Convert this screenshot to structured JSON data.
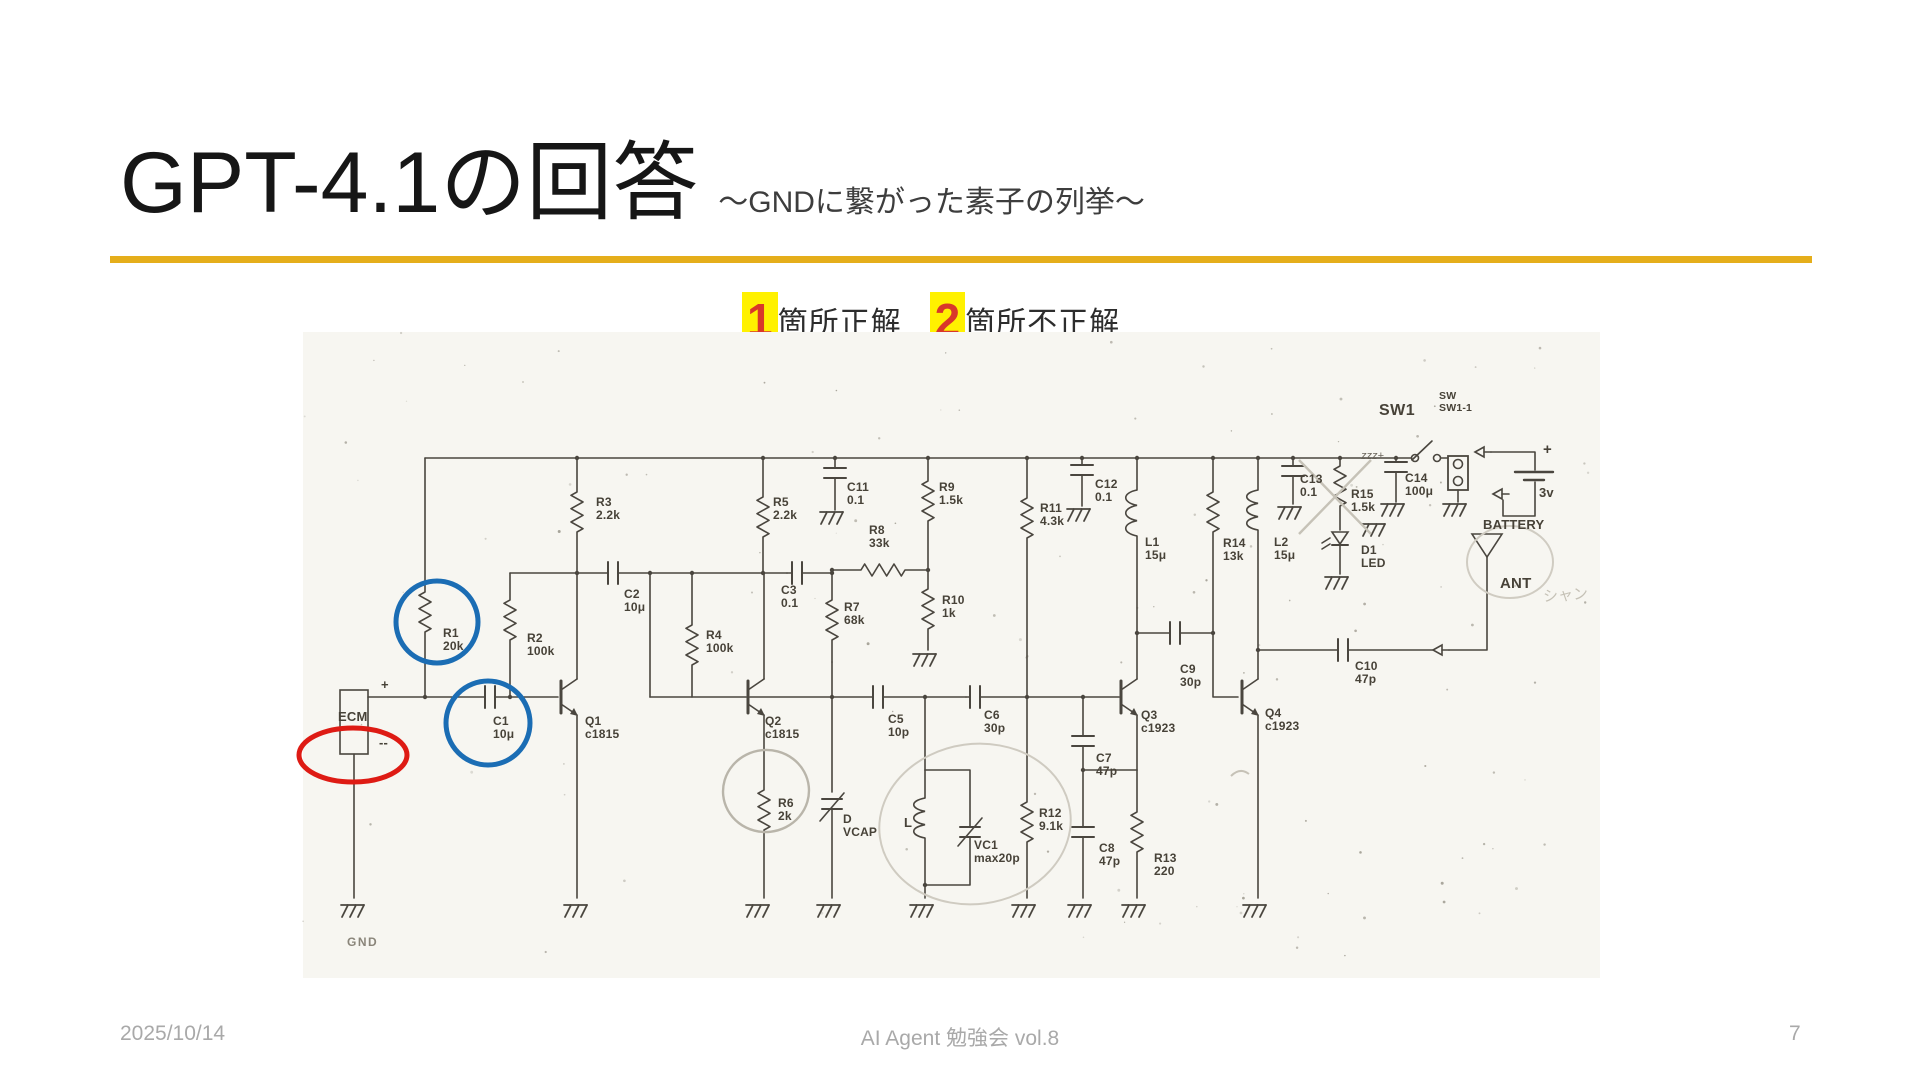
{
  "slide": {
    "title": "GPT-4.1の回答",
    "subtitle": "～GNDに繋がった素子の列挙～",
    "result": {
      "correct_count": "1",
      "correct_label": "箇所正解",
      "incorrect_count": "2",
      "incorrect_label": "箇所不正解"
    },
    "footer": {
      "date": "2025/10/14",
      "event": "AI Agent 勉強会 vol.8",
      "page": "7"
    }
  },
  "colors": {
    "rule_gold": "#E5AE1B",
    "highlight_yellow": "#FFF100",
    "count_red": "#D9372A",
    "annotation_blue": "#1B6DB4",
    "annotation_red": "#DE1B14",
    "ink": "#4a463f",
    "pencil": "#c6c2b7",
    "paper": "#f7f6f1"
  },
  "circuit": {
    "labels": [
      {
        "t": "R1\n20k",
        "x": 140,
        "y": 295
      },
      {
        "t": "R2\n100k",
        "x": 224,
        "y": 300
      },
      {
        "t": "C1\n10μ",
        "x": 190,
        "y": 383
      },
      {
        "t": "Q1\nc1815",
        "x": 282,
        "y": 383
      },
      {
        "t": "ECM",
        "x": 35,
        "y": 378,
        "s": "md"
      },
      {
        "t": "+",
        "x": 78,
        "y": 346,
        "s": "md"
      },
      {
        "t": "--",
        "x": 76,
        "y": 404,
        "s": "md"
      },
      {
        "t": "GND",
        "x": 44,
        "y": 604,
        "s": "gndlbl"
      },
      {
        "t": "R3\n2.2k",
        "x": 293,
        "y": 164
      },
      {
        "t": "C2\n10μ",
        "x": 321,
        "y": 256
      },
      {
        "t": "R4\n100k",
        "x": 403,
        "y": 297
      },
      {
        "t": "R5\n2.2k",
        "x": 470,
        "y": 164
      },
      {
        "t": "C3\n0.1",
        "x": 478,
        "y": 252
      },
      {
        "t": "C11\n0.1",
        "x": 544,
        "y": 149
      },
      {
        "t": "R9\n1.5k",
        "x": 636,
        "y": 149
      },
      {
        "t": "R8\n33k",
        "x": 566,
        "y": 192
      },
      {
        "t": "R7\n68k",
        "x": 541,
        "y": 269
      },
      {
        "t": "R10\n1k",
        "x": 639,
        "y": 262
      },
      {
        "t": "Q2\nc1815",
        "x": 462,
        "y": 383
      },
      {
        "t": "R6\n2k",
        "x": 475,
        "y": 465
      },
      {
        "t": "D\nVCAP",
        "x": 540,
        "y": 481
      },
      {
        "t": "C5\n10p",
        "x": 585,
        "y": 381
      },
      {
        "t": "C6\n30p",
        "x": 681,
        "y": 377
      },
      {
        "t": "L",
        "x": 601,
        "y": 484,
        "s": "md"
      },
      {
        "t": "VC1\nmax20p",
        "x": 671,
        "y": 507
      },
      {
        "t": "R12\n9.1k",
        "x": 736,
        "y": 475
      },
      {
        "t": "C7\n47p",
        "x": 793,
        "y": 420
      },
      {
        "t": "C8\n47p",
        "x": 796,
        "y": 510
      },
      {
        "t": "R13\n220",
        "x": 851,
        "y": 520
      },
      {
        "t": "R11\n4.3k",
        "x": 737,
        "y": 170
      },
      {
        "t": "C12\n0.1",
        "x": 792,
        "y": 146
      },
      {
        "t": "L1\n15μ",
        "x": 842,
        "y": 204
      },
      {
        "t": "Q3\nc1923",
        "x": 838,
        "y": 377
      },
      {
        "t": "C9\n30p",
        "x": 877,
        "y": 331
      },
      {
        "t": "R14\n13k",
        "x": 920,
        "y": 205
      },
      {
        "t": "L2\n15μ",
        "x": 971,
        "y": 204
      },
      {
        "t": "C13\n0.1",
        "x": 997,
        "y": 141
      },
      {
        "t": "R15\n1.5k",
        "x": 1048,
        "y": 156
      },
      {
        "t": "C14\n100μ",
        "x": 1102,
        "y": 140
      },
      {
        "t": "D1\nLED",
        "x": 1058,
        "y": 212
      },
      {
        "t": "SW1",
        "x": 1076,
        "y": 70,
        "s": "swbold"
      },
      {
        "t": "SW\nSW1-1",
        "x": 1136,
        "y": 58,
        "s": "sm"
      },
      {
        "t": "+",
        "x": 1240,
        "y": 110,
        "s": "lg"
      },
      {
        "t": "3v",
        "x": 1236,
        "y": 154,
        "s": "md"
      },
      {
        "t": "BATTERY",
        "x": 1180,
        "y": 186,
        "s": "md"
      },
      {
        "t": "ANT",
        "x": 1197,
        "y": 244,
        "s": "lg"
      },
      {
        "t": "C10\n47p",
        "x": 1052,
        "y": 328
      },
      {
        "t": "Q4\nc1923",
        "x": 962,
        "y": 375
      }
    ],
    "handwriting": [
      {
        "t": "zzz+",
        "x": 1058,
        "y": 118,
        "c": "ink"
      },
      {
        "t": "シャン",
        "x": 1240,
        "y": 252,
        "c": "pencil"
      }
    ]
  }
}
